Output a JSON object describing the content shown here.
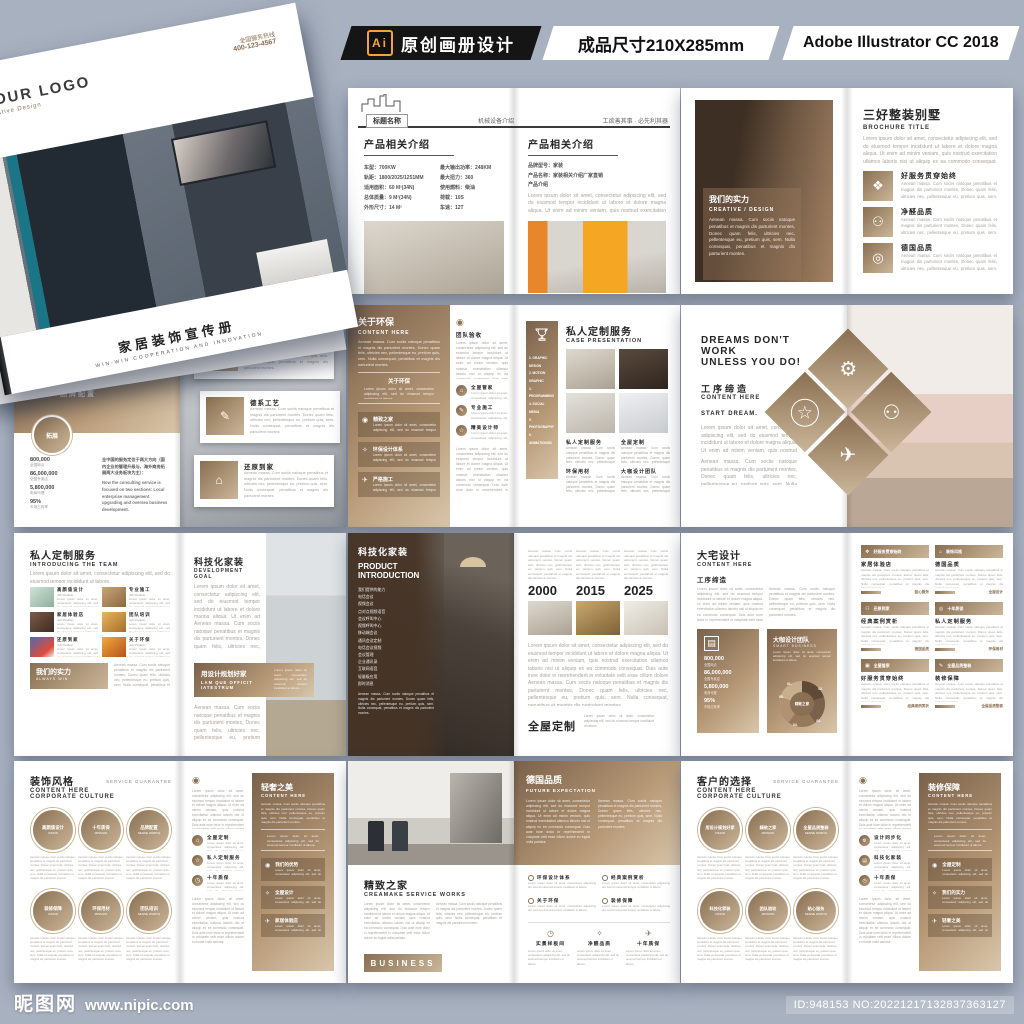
{
  "colors": {
    "background": "#a8b1c0",
    "accent_brown": "#8a6f52",
    "accent_brown_light": "#cbb699",
    "topbar_black": "#151515",
    "ai_orange": "#f2a33c"
  },
  "topbar": {
    "ai_badge": "Ai",
    "label_design": "原创画册设计",
    "label_size": "成品尺寸210X285mm",
    "label_software": "Adobe Illustrator CC 2018"
  },
  "footer": {
    "site_name": "昵图网",
    "site_url": "www.nipic.com",
    "id_text": "ID:948153 NO:20221217132837363127"
  },
  "icons": {
    "org": "❖",
    "purity": "⚇",
    "target": "◎",
    "people": "⚇",
    "gear": "⚙",
    "plane": "✈",
    "star": "☆",
    "pin": "◉",
    "bulb": "✧",
    "clock": "◷",
    "chart": "▤",
    "trophy": "♕",
    "megaphone": "◄",
    "logo_dot": "◉",
    "camera": "▣",
    "leaf": "✿",
    "home": "⌂",
    "tool": "✎"
  },
  "lorem": {
    "p": "Lorem ipsum dolor sit amet, consectetur adipiscing elit, sed do eiusmod tempor incididunt ut labore et dolore magna aliqua. Ut enim ad minim veniam, quis nostrud exercitation ullamco laboris nisi ut aliquip ex ea commodo consequat. Duis aute irure dolor in reprehenderit in voluptate velit esse cillum dolore eu fugiat nulla pariatur.",
    "m": "Aenean massa. Cum sociis natoque penatibus et magnis dis parturient montes, Donec quam felis, ultricies nec, pellentesque eu, pretium quis, sem. Nulla consequat, penatibus et magnis dis parturient montes.",
    "s": "Lorem ipsum dolor sit amet, consectetur adipiscing elit, sed do eiusmod tempor incididunt ut labore."
  },
  "cover": {
    "logo": "YOUR LOGO",
    "logo_sub": "Creative Design",
    "contact1": "全国服务热线",
    "contact2": "400-123-4567",
    "title": "家居装饰宣传册",
    "subtitle": "WIN-WIN COOPERATION AND INNOVATION"
  },
  "s1": {
    "logo_label": "标题名称",
    "header_center": "机械设备介绍",
    "header_right": "工欲善其事 · 必先利其器",
    "left_title": "产品相关介绍",
    "specs_l": [
      "车型：700KW",
      "轨距：1800/2025/1251MM",
      "适用面积：60 M²(34N)",
      "总体质量：9 M²(34N)",
      "外形尺寸：14 M²"
    ],
    "specs_r": [
      "最大输出功率：248KM",
      "最大扭力：360",
      "使用燃料：柴油",
      "荷载：10S",
      "车速：12T"
    ],
    "right_title": "产品相关介绍",
    "right_rows": [
      "品牌型号：家装",
      "产品名称：家装相关介绍厂家直销",
      "产品介绍"
    ]
  },
  "s2": {
    "overlay_title": "我们的实力",
    "overlay_sub": "CREATIVE / DESIGN",
    "title": "三好整装别墅",
    "subtitle": "BROCHURE TITLE",
    "items": [
      {
        "title": "好服务贯穿始终"
      },
      {
        "title": "净醛品质"
      },
      {
        "title": "德国品质"
      }
    ]
  },
  "s3": {
    "no_left": "N°03",
    "no_right": "N°04",
    "title": "好服务贯穿始终",
    "tabs": [
      "WORKER",
      "STUDY",
      "CASE"
    ],
    "sub": "品牌配置",
    "circle": "拓展",
    "stats": [
      {
        "v": "800,000",
        "k": "全国网点"
      },
      {
        "v": "86,000,000",
        "k": "全国专卖店"
      },
      {
        "v": "5,800,000",
        "k": "电商代理"
      },
      {
        "v": "95%",
        "k": "市场占有率"
      }
    ],
    "para_cn": "全中国的服务定位于两大方向（国内企业的管理升级与、海外商务拓展两大业务板块为主）：",
    "para_en": "Now the consulting service is focused on two sections: Local enterprise management upgrading and oversea business development.",
    "cards": [
      {
        "title": "装饰风格"
      },
      {
        "title": "德系工艺"
      },
      {
        "title": "还原到家"
      }
    ]
  },
  "s4": {
    "title": "关于环保",
    "subtitle": "CONTENT HERE",
    "quote": "关于环保",
    "rows": [
      "精致之家",
      "环保设计体系",
      "严格施工"
    ],
    "col_title": "团队验收",
    "col_items": [
      "全屋管家",
      "专业施工",
      "精美设计师"
    ],
    "right_title": "私人定制服务",
    "right_sub": "CASE PRESENTATION",
    "banner": [
      "1. GRAPHIC DESIGN",
      "2. MOTION GRAPHIC",
      "3. PROGRAMMING",
      "4. SOCIAL MEDIA",
      "5. PHOTOGRAPHY",
      "6. ANIMATION/3D"
    ],
    "cols": [
      "私人定制服务",
      "全屋定制",
      "环保用材",
      "大咖设计团队"
    ]
  },
  "s5": {
    "title1": "DREAMS DON'T WORK",
    "title2": "UNLESS YOU DO!",
    "cn": "工序缔造",
    "subtitle": "CONTENT HERE",
    "start": "START DREAM."
  },
  "s6": {
    "title": "私人定制服务",
    "subtitle": "INTRODUCING THE TEAM",
    "grid": [
      {
        "t": "高颜值设计"
      },
      {
        "t": "专业施工"
      },
      {
        "t": "家居体验店"
      },
      {
        "t": "团队培训"
      },
      {
        "t": "还原到家"
      },
      {
        "t": "关于环保"
      }
    ],
    "grid_sub": "Job Position",
    "banner_t": "我们的实力",
    "banner_s": "ALWAYS WIN",
    "right_title": "科技化家装",
    "right_sub": "DEVELOPMENT GOAL",
    "box_t": "用设计规划好家",
    "box_s": "LAM QUE OFFICIT IATESTRUM"
  },
  "s7": {
    "title": "科技化家装",
    "sub1": "PRODUCT",
    "sub2": "INTRODUCTION",
    "list": [
      "我们提供的能力",
      "电话会议",
      "视频会议",
      "点对点视频语音",
      "会议呼叫中心",
      "视频呼叫中心",
      "移动端会议",
      "通讯会议定制",
      "电话会议视频",
      "会议管理",
      "企业通讯录",
      "互联网语音",
      "轻量级应用",
      "即时消息"
    ],
    "years": [
      "2000",
      "2015",
      "2025"
    ],
    "bottom_title": "全屋定制"
  },
  "s8": {
    "title": "大宅设计",
    "subtitle": "CONTENT HERE",
    "sec": "工序缔造",
    "stats": [
      {
        "v": "800,000",
        "k": "全国网点"
      },
      {
        "v": "86,000,000",
        "k": "全国专卖店"
      },
      {
        "v": "5,800,000",
        "k": "电商代理"
      },
      {
        "v": "95%",
        "k": "市场占有率"
      }
    ],
    "team_t": "大咖设计团队",
    "team_s": "SMART BUSINESS",
    "donut": [
      "01.",
      "02.",
      "03.",
      "04.",
      "05."
    ],
    "donut_center": "精致之家",
    "cards": [
      {
        "h": "好服务贯穿始终",
        "t": "家居体验店",
        "f": "贴心服务"
      },
      {
        "h": "装饰风格",
        "t": "德国品质",
        "f": "全屋设计"
      },
      {
        "h": "还原到家",
        "t": "经典案例赏析",
        "f": "德国品质"
      },
      {
        "h": "十年质保",
        "t": "私人定制服务",
        "f": "环保用材"
      },
      {
        "h": "全屋管家",
        "t": "好服务贯穿始终",
        "f": "经典案例赏析"
      },
      {
        "h": "全屋品质整装",
        "t": "装修保障",
        "f": "全屋品质整装"
      }
    ]
  },
  "s9": {
    "title": "装饰风格",
    "sub1": "CONTENT HERE",
    "sub2": "CORPORATE CULTURE",
    "corner": "SERVICE GUARANTEE",
    "circles": [
      {
        "t": "高颜值设计",
        "s": "VISION"
      },
      {
        "t": "十年质保",
        "s": "MISSION"
      },
      {
        "t": "品牌配置",
        "s": "SENSE WORTH"
      },
      {
        "t": "装修保障",
        "s": "VISION"
      },
      {
        "t": "环保用材",
        "s": "MISSION"
      },
      {
        "t": "团队培训",
        "s": "SENSE WORTH"
      }
    ],
    "mini": [
      "全屋定制",
      "私人定制服务",
      "十年质保"
    ],
    "panel_t": "轻奢之美",
    "panel_s": "CONTENT HERE",
    "panel_items": [
      "我们的优势",
      "全屋设计",
      "家居体验店"
    ]
  },
  "s10": {
    "top_title": "德国品质",
    "top_sub": "FUTURE EXPECTATION",
    "bl_title": "精致之家",
    "bl_sub": "CREAMAKE SERVICE WORKS",
    "btn": "BUSINESS",
    "bullets": [
      "环保设计体系",
      "经典案例赏析",
      "关于环保",
      "装修保障"
    ],
    "cols": [
      {
        "t": "实景样板间"
      },
      {
        "t": "净醛品质"
      },
      {
        "t": "十年质保"
      }
    ]
  },
  "s11": {
    "title": "客户的选择",
    "sub1": "CONTENT HERE",
    "sub2": "CORPORATE CULTURE",
    "corner": "SERVICE GUARANTEE",
    "circles": [
      {
        "t": "用设计规划好家",
        "s": "VISION"
      },
      {
        "t": "精致之家",
        "s": "MISSION"
      },
      {
        "t": "全屋品质整装",
        "s": "SENSE WORTH"
      },
      {
        "t": "科技化家装",
        "s": "VISION"
      },
      {
        "t": "团队验收",
        "s": "MISSION"
      },
      {
        "t": "贴心服务",
        "s": "SENSE WORTH"
      }
    ],
    "mini": [
      "设计同步化",
      "科技化家装",
      "十年质保"
    ],
    "panel_t": "装修保障",
    "panel_s": "CONTENT HERE",
    "panel_items": [
      "全屋定制",
      "我们的实力",
      "轻奢之美"
    ]
  }
}
